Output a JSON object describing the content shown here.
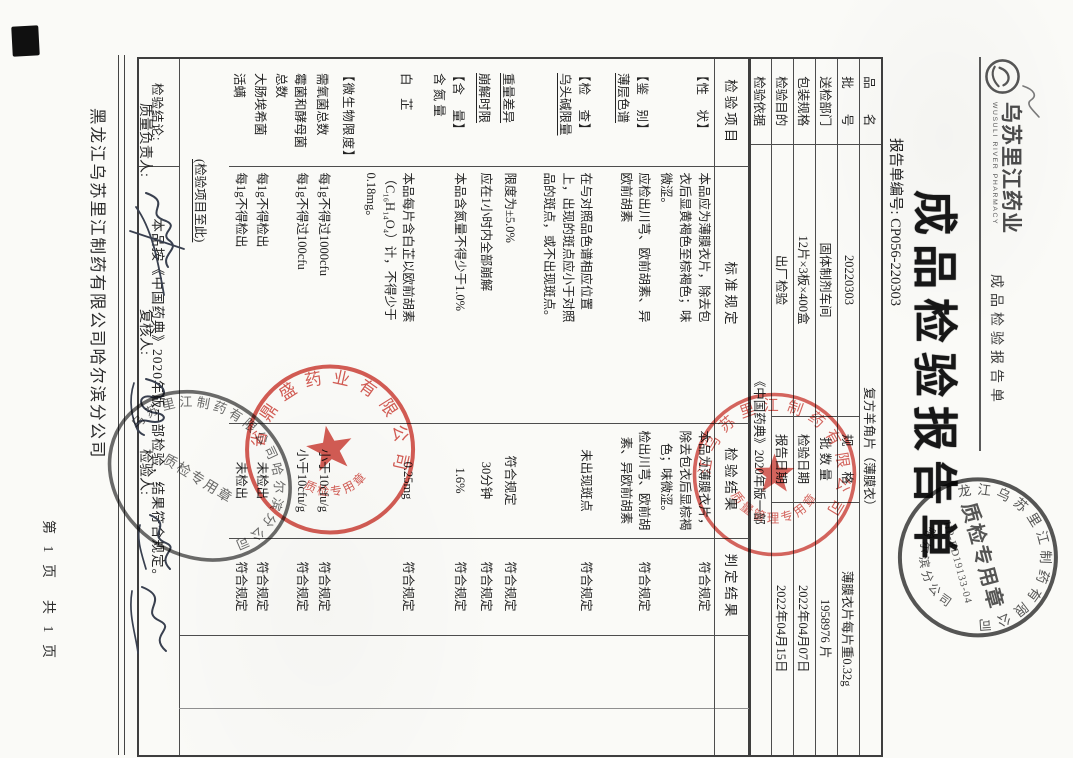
{
  "header": {
    "logo_name": "乌苏里江药业",
    "logo_sub": "WUSULI RIVER PHARMACY",
    "doc_type_small": "成品检验报告单",
    "title": "成品检验报告单",
    "report_no": "报告单编号: CP056-220303"
  },
  "info_table": {
    "rows": [
      {
        "l1": "品　　名",
        "v1": "复方羊角片（薄膜衣）"
      },
      {
        "l1": "批　　号",
        "v1": "20220303",
        "l2": "规　　格",
        "v2": "薄膜衣片每片重0.32g"
      },
      {
        "l1": "送检部门",
        "v1": "固体制剂车间",
        "l2": "批 数 量",
        "v2": "1958976 片"
      },
      {
        "l1": "包装规格",
        "v1": "12片×3板×400盒",
        "l2": "检验日期",
        "v2": "2022年04月07日"
      },
      {
        "l1": "检验目的",
        "v1": "出厂检验",
        "l2": "报告日期",
        "v2": "2022年04月15日"
      },
      {
        "l1": "检验依据",
        "v1": "《中国药典》2020年版一部"
      }
    ]
  },
  "main_table": {
    "headers": [
      "检验项目",
      "标准规定",
      "检验结果",
      "判定结果"
    ],
    "rows": [
      {
        "item": "【性　状】",
        "std": "本品应为薄膜衣片，除去包衣后显黄褐色至棕褐色；味微涩。",
        "res": "本品为薄膜衣片，除去包衣后显棕褐色；味微涩。",
        "jud": "符合规定"
      },
      {
        "item": "【鉴　别】",
        "item2": "薄层色谱",
        "std": "应检出川芎、欧前胡素、异欧前胡素",
        "res": "检出川芎、欧前胡素、异欧前胡素",
        "jud": "符合规定"
      },
      {
        "item": "【检　查】",
        "item2": "乌头碱限量",
        "std": "在与对照品色谱相应位置上，出现的斑点应小于对照品的斑点，或不出现斑点。",
        "res": "未出现斑点",
        "jud": "符合规定"
      },
      {
        "item2": "重量差异",
        "std": "限度为±5.0%",
        "res": "符合规定",
        "jud": "符合规定"
      },
      {
        "item2": "崩解时限",
        "std": "应在1小时内全部崩解",
        "res": "30分钟",
        "jud": "符合规定"
      },
      {
        "item": "【含　量】",
        "item2": "含 氮 量",
        "std": "本品含氮量不得少于1.0%",
        "res": "1.6%",
        "jud": "符合规定"
      },
      {
        "item2": "白　芷",
        "std": "本品每片含白芷以欧前胡素（C₁₆H₁₄O₄）计，不得少于0.18mg。",
        "res": "0.25mg",
        "jud": "符合规定"
      },
      {
        "item": "【微生物限度】"
      },
      {
        "item2": "需氧菌总数",
        "std": "每1g不得过1000cfu",
        "res": "小于10cfu/g",
        "jud": "符合规定"
      },
      {
        "item2": "霉菌和酵母菌总数",
        "std": "每1g不得过100cfu",
        "res": "小于10cfu/g",
        "jud": "符合规定"
      },
      {
        "item2": "大肠埃希菌",
        "std": "每1g不得检出",
        "res": "未检出",
        "jud": "符合规定"
      },
      {
        "item2": "活螨",
        "std": "每1g不得检出",
        "res": "未检出",
        "jud": "符合规定"
      }
    ],
    "end_note": "(检验项目至此)",
    "conclusion_label": "检验结论:",
    "conclusion_text": "本品按《中国药典》2020年版一部检验，结果符合规定。"
  },
  "signatures": {
    "quality_label": "质量负责人:",
    "review_label": "复核人:",
    "inspector_label": "检验人:"
  },
  "footer": {
    "company": "黑龙江乌苏里江制药有限公司哈尔滨分公司",
    "page": "第 1 页　共 1 页"
  },
  "stamps": {
    "qm_red": {
      "ring": "黑龙江乌苏里江制药有限公司",
      "center": "质量管理专用章"
    },
    "jl_red": {
      "ring": "吉林省鼎盛药业有限公司",
      "center": "质检专用章"
    },
    "oval_black": {
      "ring": "黑龙江乌苏里江制药有限公司哈尔滨分公司",
      "center": "质检专用章"
    },
    "qc_black": {
      "ring_top": "黑龙江乌苏里江制药有限公司",
      "ring_bottom": "哈尔滨分公司",
      "center": "质检专用章",
      "code": "HP-RD19133-04"
    }
  },
  "colors": {
    "stamp_red": "#cf4038",
    "stamp_black": "#3f3f3f",
    "ink": "#2e3440",
    "paper": "#fafaf7"
  }
}
